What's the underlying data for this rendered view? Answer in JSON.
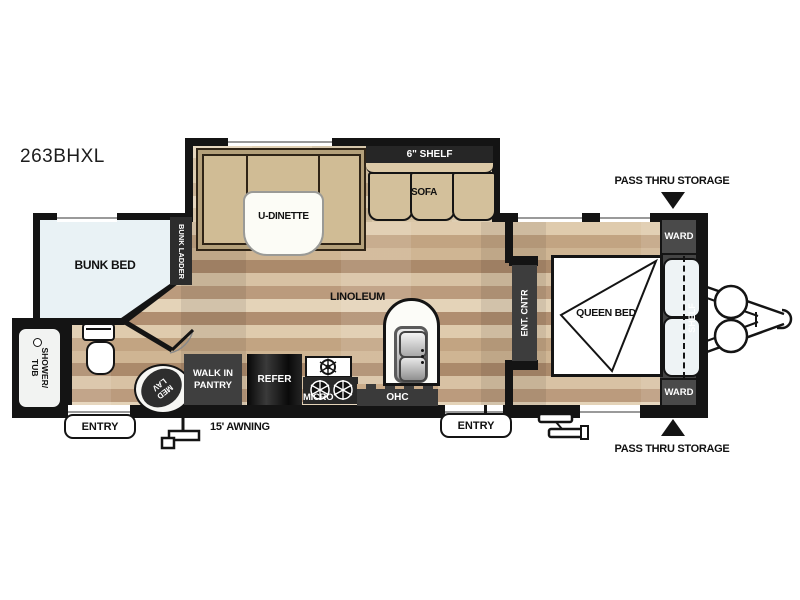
{
  "model": "263BHXL",
  "colors": {
    "wall": "#141414",
    "cabinet_dark": "#3f3f3f",
    "wood_base": "#c9ab89",
    "bunk_fill": "#e9f2f5",
    "furniture_tan": "#d0bc95",
    "bed_white": "#ffffff"
  },
  "exterior": {
    "pass_thru_top": "PASS THRU STORAGE",
    "pass_thru_bottom": "PASS THRU STORAGE",
    "awning": "15' AWNING",
    "entry_left": "ENTRY",
    "entry_main": "ENTRY"
  },
  "bedroom": {
    "queen_bed": "QUEEN BED",
    "ward_top": "WARD",
    "ward_bottom": "WARD",
    "shelf": "SHELF",
    "ent_cntr": "ENT. CNTR"
  },
  "living": {
    "u_dinette": "U-DINETTE",
    "sofa": "SOFA",
    "shelf_6": "6\" SHELF",
    "linoleum": "LINOLEUM"
  },
  "kitchen": {
    "pantry_line1": "WALK IN",
    "pantry_line2": "PANTRY",
    "refer": "REFER",
    "micro": "MICRO",
    "ohc": "OHC"
  },
  "bath": {
    "shower_line1": "SHOWER/",
    "shower_line2": "TUB",
    "med_line1": "MED",
    "med_line2": "LAV"
  },
  "bunk_room": {
    "bunk_bed": "BUNK BED",
    "bunk_ladder": "BUNK LADDER"
  }
}
